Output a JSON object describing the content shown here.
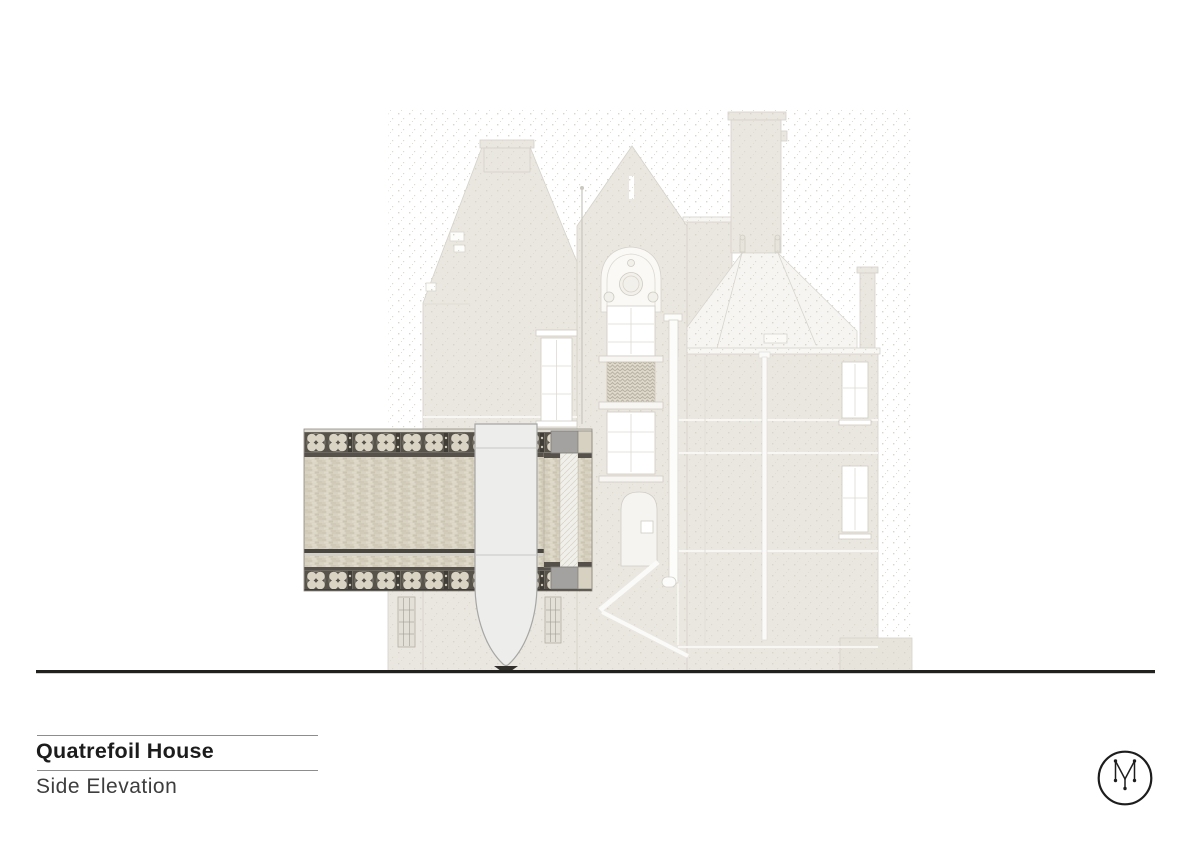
{
  "title_block": {
    "project_name": "Quatrefoil House",
    "drawing_name": "Side Elevation"
  },
  "logo": {
    "icon": "circle-monogram-icon"
  },
  "drawing": {
    "type": "architectural side elevation",
    "elements": [
      "existing-house-elevation",
      "left-gable-tower",
      "central-gable",
      "tall-chimney-stack",
      "hipped-roof-pavilion",
      "quatrefoil-tile-frieze-top",
      "brick-band-field",
      "quatrefoil-tile-frieze-bottom",
      "capsule-bay-element",
      "ground-line"
    ],
    "palette": {
      "paper": "#ffffff",
      "existing_wall": "#eae7e0",
      "roof_white": "#f6f5f1",
      "band_brick": "#d8d2c2",
      "frieze_dark": "#57534b",
      "frieze_quatrefoil": "#dad4c5",
      "capsule_fill": "#ededec",
      "steel_grey": "#a3a2a0",
      "ground_line": "#21211e",
      "text": "#1c1c1c"
    }
  }
}
